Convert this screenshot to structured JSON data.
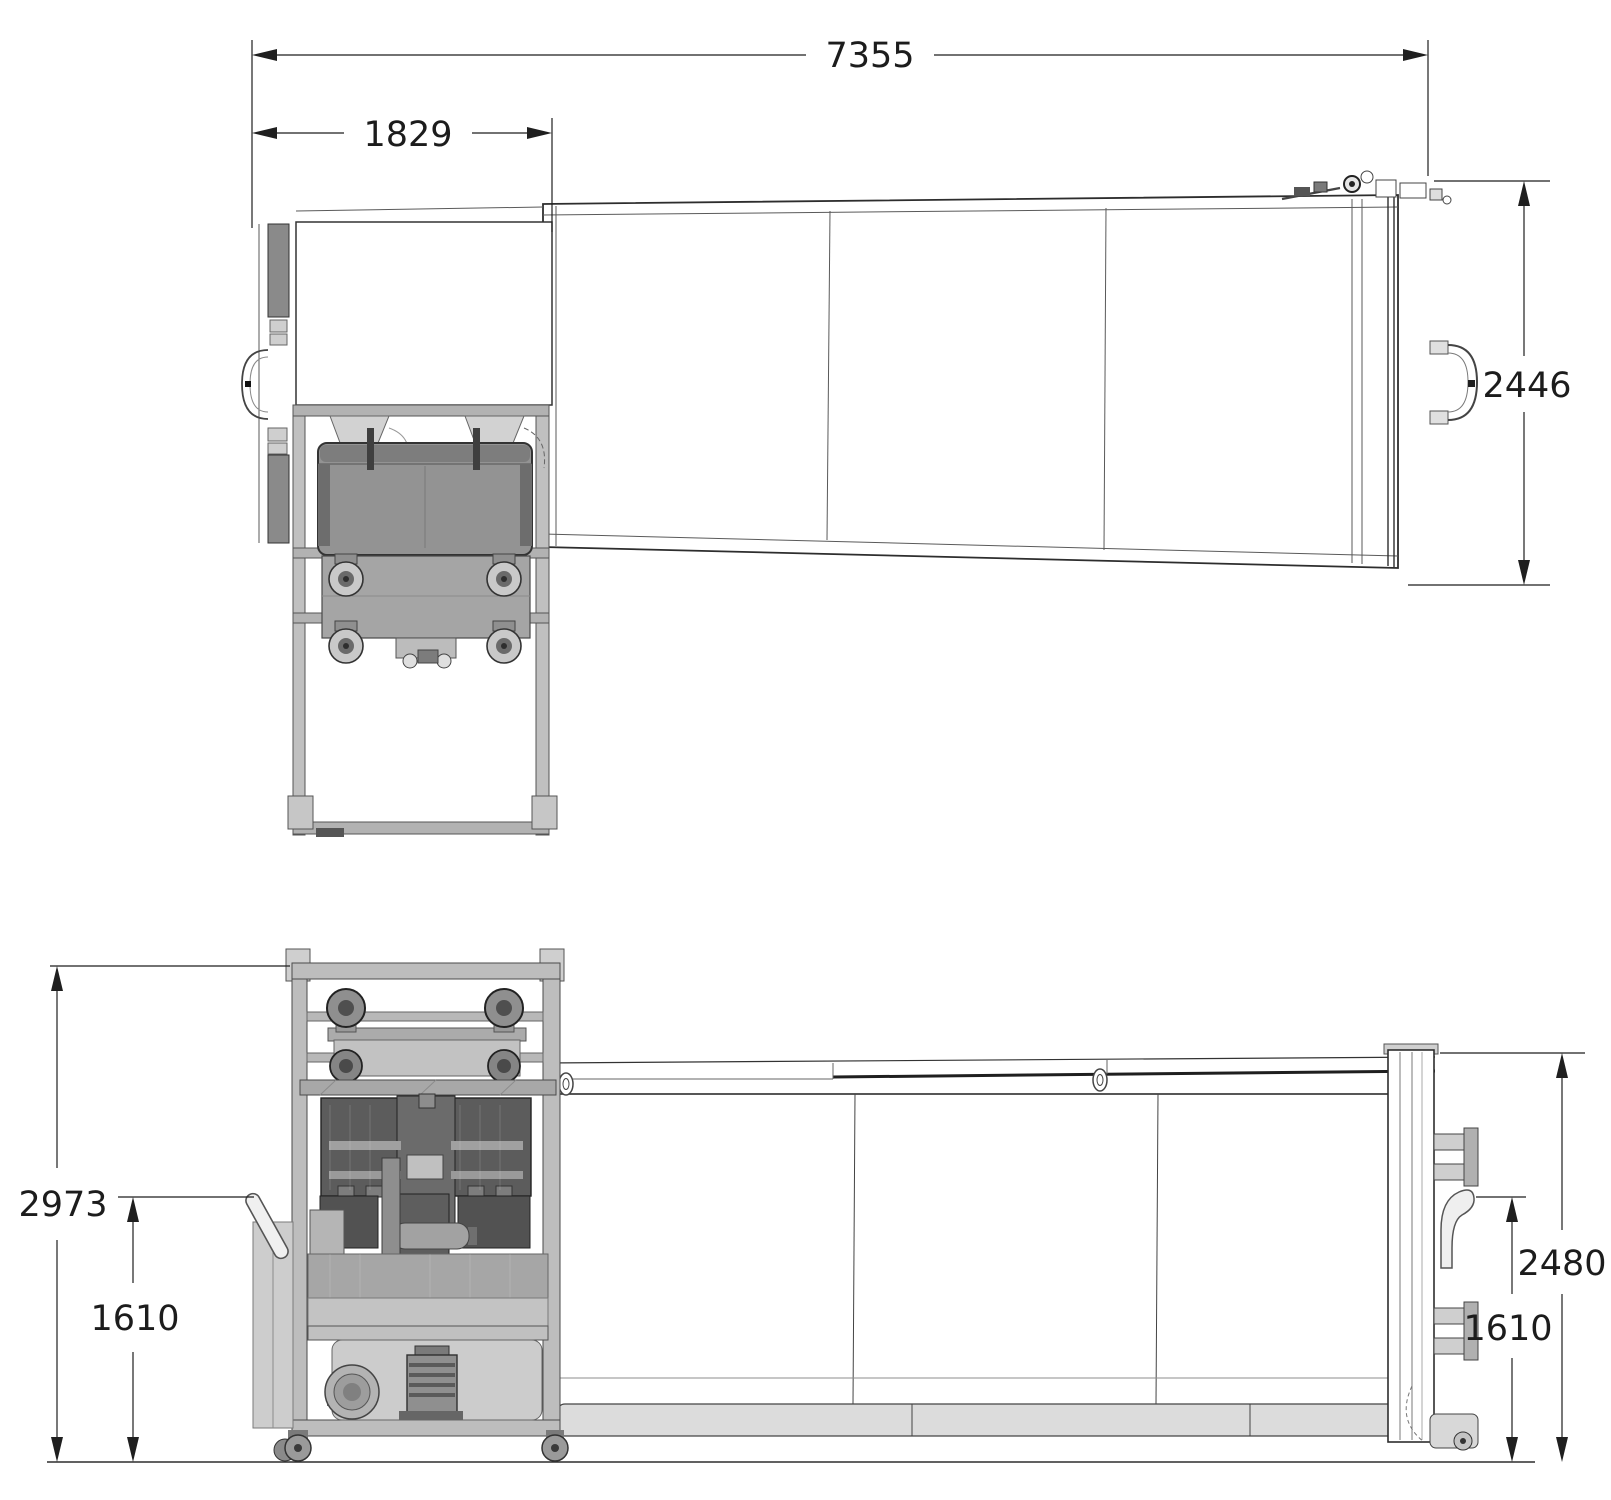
{
  "dimensions": {
    "overall_length": "7355",
    "feed_unit_length": "1829",
    "container_width": "2446",
    "overall_height": "2973",
    "left_handle_height": "1610",
    "container_height": "2480",
    "right_hook_height": "1610"
  }
}
